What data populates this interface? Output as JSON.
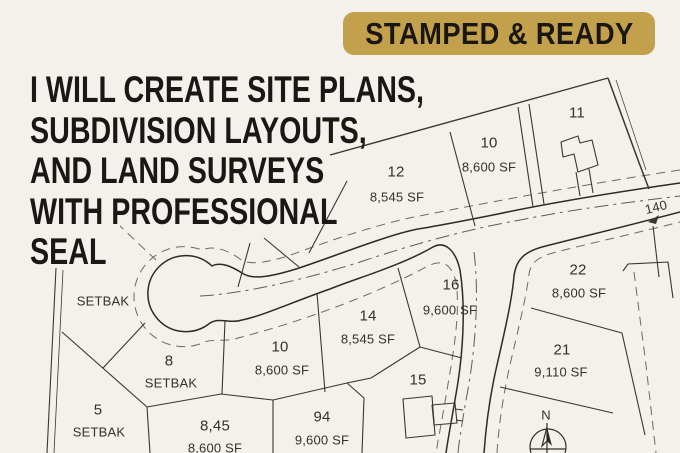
{
  "badge": {
    "text": "STAMPED & READY",
    "bg": "#c2a04c",
    "fg": "#1a1712"
  },
  "headline": {
    "color": "#1a1814",
    "lines": [
      "I WILL CREATE SITE PLANS,",
      "SUBDIVISION LAYOUTS,",
      "AND LAND SURVEYS",
      "WITH PROFESSIONAL",
      "SEAL"
    ]
  },
  "plat": {
    "bg": "#f4f1ec",
    "line_color": "#3a3731",
    "dash_color": "#6e6a61",
    "labels": [
      {
        "text": "12",
        "x": 396,
        "y": 172,
        "fs": 15
      },
      {
        "text": "8,545 SF",
        "x": 397,
        "y": 197,
        "fs": 13
      },
      {
        "text": "10",
        "x": 489,
        "y": 143,
        "fs": 15
      },
      {
        "text": "8,600 SF",
        "x": 489,
        "y": 167,
        "fs": 13
      },
      {
        "text": "11",
        "x": 577,
        "y": 113,
        "fs": 15
      },
      {
        "text": "140",
        "x": 656,
        "y": 207,
        "fs": 13,
        "rot": -14
      },
      {
        "text": "22",
        "x": 578,
        "y": 270,
        "fs": 15
      },
      {
        "text": "8,600 SF",
        "x": 579,
        "y": 293,
        "fs": 13
      },
      {
        "text": "16",
        "x": 451,
        "y": 285,
        "fs": 15
      },
      {
        "text": "9,600 SF",
        "x": 450,
        "y": 310,
        "fs": 13
      },
      {
        "text": "14",
        "x": 368,
        "y": 316,
        "fs": 15
      },
      {
        "text": "8,545 SF",
        "x": 368,
        "y": 339,
        "fs": 13
      },
      {
        "text": "21",
        "x": 562,
        "y": 350,
        "fs": 15
      },
      {
        "text": "9,110 SF",
        "x": 561,
        "y": 372,
        "fs": 13
      },
      {
        "text": "15",
        "x": 418,
        "y": 380,
        "fs": 15
      },
      {
        "text": "10",
        "x": 280,
        "y": 347,
        "fs": 15
      },
      {
        "text": "8,600 SF",
        "x": 282,
        "y": 370,
        "fs": 13
      },
      {
        "text": "SETBAK",
        "x": 103,
        "y": 301,
        "fs": 13
      },
      {
        "text": "8",
        "x": 169,
        "y": 361,
        "fs": 15
      },
      {
        "text": "SETBAK",
        "x": 171,
        "y": 383,
        "fs": 13
      },
      {
        "text": "5",
        "x": 98,
        "y": 410,
        "fs": 15
      },
      {
        "text": "SETBAK",
        "x": 99,
        "y": 432,
        "fs": 13
      },
      {
        "text": "8,45",
        "x": 215,
        "y": 426,
        "fs": 15
      },
      {
        "text": "8,600 SF",
        "x": 215,
        "y": 448,
        "fs": 13
      },
      {
        "text": "94",
        "x": 322,
        "y": 417,
        "fs": 15
      },
      {
        "text": "9,600 SF",
        "x": 322,
        "y": 440,
        "fs": 13
      },
      {
        "text": "N",
        "x": 546,
        "y": 415,
        "fs": 13
      }
    ]
  }
}
